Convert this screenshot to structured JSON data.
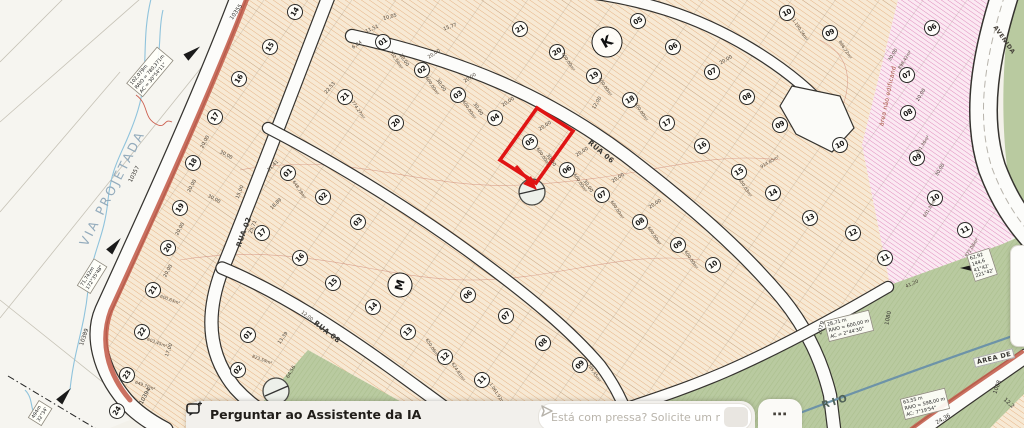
{
  "assistant_bar": {
    "ask_button": "Perguntar ao Assistente da IA",
    "input_placeholder": "Está com pressa? Solicite um resumo rápido",
    "more_label": "⋯"
  },
  "map": {
    "highlighted_lot": {
      "number": "05",
      "area": "600,00m²"
    },
    "colors": {
      "highlight": "#e01414",
      "road_stripe": "#c4604f",
      "lots_tan": "#f7e9d4",
      "lots_pink": "#fbe9f2",
      "green": "#b9caa0",
      "water": "#6d93a8"
    },
    "streets": [
      {
        "t": "VIA PROJETADA",
        "x": 112,
        "y": 188,
        "r": -63,
        "cls": "via"
      },
      {
        "t": "RUA 02",
        "x": 244,
        "y": 232,
        "r": -70,
        "cls": ""
      },
      {
        "t": "RUA 08",
        "x": 327,
        "y": 332,
        "r": 38,
        "cls": ""
      },
      {
        "t": "RUA 06",
        "x": 601,
        "y": 152,
        "r": 40,
        "cls": ""
      },
      {
        "t": "AVENIDA",
        "x": 1004,
        "y": 40,
        "r": 55,
        "cls": "ave"
      },
      {
        "t": "RIO",
        "x": 836,
        "y": 402,
        "r": -17,
        "cls": "rio"
      },
      {
        "t": "ÁREA DE",
        "x": 994,
        "y": 358,
        "r": -14,
        "cls": "areade"
      },
      {
        "t": "área não edificand",
        "x": 888,
        "y": 96,
        "r": -78,
        "cls": "nae"
      }
    ],
    "blocks": [
      {
        "t": "K",
        "x": 607,
        "y": 42,
        "r": -30,
        "cls": ""
      },
      {
        "t": "M",
        "x": 400,
        "y": 285,
        "r": -75,
        "cls": "m"
      }
    ],
    "lots": [
      {
        "n": "14",
        "x": 295,
        "y": 12,
        "r": -58
      },
      {
        "n": "15",
        "x": 270,
        "y": 47,
        "r": -58
      },
      {
        "n": "16",
        "x": 239,
        "y": 79,
        "r": -58
      },
      {
        "n": "17",
        "x": 215,
        "y": 117,
        "r": -58
      },
      {
        "n": "18",
        "x": 193,
        "y": 163,
        "r": -58
      },
      {
        "n": "19",
        "x": 180,
        "y": 208,
        "r": -58
      },
      {
        "n": "20",
        "x": 168,
        "y": 248,
        "r": -58
      },
      {
        "n": "21",
        "x": 153,
        "y": 290,
        "r": -58
      },
      {
        "n": "22",
        "x": 142,
        "y": 332,
        "r": -58
      },
      {
        "n": "23",
        "x": 127,
        "y": 375,
        "r": -58
      },
      {
        "n": "24",
        "x": 117,
        "y": 411,
        "r": -58
      },
      {
        "n": "01",
        "x": 288,
        "y": 173,
        "r": -45
      },
      {
        "n": "02",
        "x": 323,
        "y": 197,
        "r": -45
      },
      {
        "n": "03",
        "x": 358,
        "y": 222,
        "r": -45
      },
      {
        "n": "06",
        "x": 468,
        "y": 295,
        "r": -45
      },
      {
        "n": "07",
        "x": 506,
        "y": 316,
        "r": -45
      },
      {
        "n": "08",
        "x": 543,
        "y": 343,
        "r": -45
      },
      {
        "n": "09",
        "x": 580,
        "y": 365,
        "r": -45
      },
      {
        "n": "17",
        "x": 262,
        "y": 233,
        "r": -45
      },
      {
        "n": "16",
        "x": 300,
        "y": 258,
        "r": -45
      },
      {
        "n": "15",
        "x": 333,
        "y": 283,
        "r": -45
      },
      {
        "n": "14",
        "x": 373,
        "y": 307,
        "r": -45
      },
      {
        "n": "13",
        "x": 408,
        "y": 332,
        "r": -45
      },
      {
        "n": "12",
        "x": 445,
        "y": 357,
        "r": -45
      },
      {
        "n": "11",
        "x": 482,
        "y": 380,
        "r": -45
      },
      {
        "n": "21",
        "x": 345,
        "y": 97,
        "r": -45
      },
      {
        "n": "20",
        "x": 396,
        "y": 123,
        "r": -45
      },
      {
        "n": "01",
        "x": 383,
        "y": 42,
        "r": -35
      },
      {
        "n": "02",
        "x": 422,
        "y": 70,
        "r": -35
      },
      {
        "n": "03",
        "x": 458,
        "y": 95,
        "r": -35
      },
      {
        "n": "04",
        "x": 495,
        "y": 118,
        "r": -35
      },
      {
        "n": "05",
        "x": 530,
        "y": 142,
        "r": -35
      },
      {
        "n": "06",
        "x": 567,
        "y": 170,
        "r": -35
      },
      {
        "n": "07",
        "x": 602,
        "y": 195,
        "r": -35
      },
      {
        "n": "08",
        "x": 640,
        "y": 222,
        "r": -35
      },
      {
        "n": "09",
        "x": 678,
        "y": 245,
        "r": -35
      },
      {
        "n": "10",
        "x": 713,
        "y": 265,
        "r": -35
      },
      {
        "n": "21",
        "x": 520,
        "y": 29,
        "r": -33
      },
      {
        "n": "20",
        "x": 557,
        "y": 52,
        "r": -33
      },
      {
        "n": "19",
        "x": 594,
        "y": 76,
        "r": -33
      },
      {
        "n": "18",
        "x": 630,
        "y": 100,
        "r": -33
      },
      {
        "n": "17",
        "x": 667,
        "y": 123,
        "r": -33
      },
      {
        "n": "16",
        "x": 702,
        "y": 146,
        "r": -33
      },
      {
        "n": "15",
        "x": 739,
        "y": 172,
        "r": -33
      },
      {
        "n": "05",
        "x": 638,
        "y": 21,
        "r": -30
      },
      {
        "n": "06",
        "x": 673,
        "y": 47,
        "r": -30
      },
      {
        "n": "07",
        "x": 712,
        "y": 72,
        "r": -30
      },
      {
        "n": "08",
        "x": 747,
        "y": 97,
        "r": -30
      },
      {
        "n": "09",
        "x": 780,
        "y": 125,
        "r": -30
      },
      {
        "n": "10",
        "x": 787,
        "y": 13,
        "r": -28
      },
      {
        "n": "09",
        "x": 830,
        "y": 33,
        "r": -28
      },
      {
        "n": "10",
        "x": 840,
        "y": 145,
        "r": -28
      },
      {
        "n": "14",
        "x": 773,
        "y": 193,
        "r": -28
      },
      {
        "n": "13",
        "x": 810,
        "y": 218,
        "r": -28
      },
      {
        "n": "12",
        "x": 853,
        "y": 233,
        "r": -28
      },
      {
        "n": "11",
        "x": 885,
        "y": 258,
        "r": -28
      },
      {
        "n": "01",
        "x": 248,
        "y": 335,
        "r": -50
      },
      {
        "n": "02",
        "x": 238,
        "y": 370,
        "r": -50
      },
      {
        "n": "06",
        "x": 932,
        "y": 28,
        "r": -30,
        "p": 1
      },
      {
        "n": "07",
        "x": 907,
        "y": 75,
        "r": -30,
        "p": 1
      },
      {
        "n": "08",
        "x": 908,
        "y": 113,
        "r": -30,
        "p": 1
      },
      {
        "n": "09",
        "x": 917,
        "y": 158,
        "r": -30,
        "p": 1
      },
      {
        "n": "10",
        "x": 935,
        "y": 198,
        "r": -30,
        "p": 1
      },
      {
        "n": "11",
        "x": 965,
        "y": 230,
        "r": -30,
        "p": 1
      }
    ],
    "dims": [
      {
        "t": "20,00",
        "x": 434,
        "y": 54,
        "r": -33
      },
      {
        "t": "20,00",
        "x": 470,
        "y": 78,
        "r": -33
      },
      {
        "t": "20,00",
        "x": 508,
        "y": 102,
        "r": -33
      },
      {
        "t": "20,00",
        "x": 545,
        "y": 126,
        "r": -33
      },
      {
        "t": "20,00",
        "x": 582,
        "y": 152,
        "r": -33
      },
      {
        "t": "20,00",
        "x": 618,
        "y": 178,
        "r": -33
      },
      {
        "t": "20,00",
        "x": 655,
        "y": 204,
        "r": -33
      },
      {
        "t": "20,00",
        "x": 205,
        "y": 142,
        "r": -62
      },
      {
        "t": "20,00",
        "x": 192,
        "y": 186,
        "r": -62
      },
      {
        "t": "20,00",
        "x": 180,
        "y": 229,
        "r": -62
      },
      {
        "t": "20,00",
        "x": 168,
        "y": 271,
        "r": -62
      },
      {
        "t": "20,00",
        "x": 921,
        "y": 95,
        "r": -58
      },
      {
        "t": "20,00",
        "x": 726,
        "y": 60,
        "r": -30
      },
      {
        "t": "30,00",
        "x": 404,
        "y": 60,
        "r": 57
      },
      {
        "t": "30,00",
        "x": 441,
        "y": 85,
        "r": 57
      },
      {
        "t": "30,00",
        "x": 478,
        "y": 109,
        "r": 57
      },
      {
        "t": "30,00",
        "x": 551,
        "y": 160,
        "r": 57
      },
      {
        "t": "30,00",
        "x": 588,
        "y": 186,
        "r": 57
      },
      {
        "t": "30,00",
        "x": 226,
        "y": 155,
        "r": 28
      },
      {
        "t": "30,00",
        "x": 214,
        "y": 199,
        "r": 28
      },
      {
        "t": "30,00",
        "x": 893,
        "y": 55,
        "r": -58
      },
      {
        "t": "30,00",
        "x": 940,
        "y": 170,
        "r": -58
      },
      {
        "t": "12,00",
        "x": 597,
        "y": 103,
        "r": -60
      },
      {
        "t": "12,00",
        "x": 307,
        "y": 316,
        "r": 38
      },
      {
        "t": "15,00",
        "x": 240,
        "y": 192,
        "r": -68
      },
      {
        "t": "10,05",
        "x": 390,
        "y": 17,
        "r": -15
      },
      {
        "t": "15,77",
        "x": 450,
        "y": 27,
        "r": -20
      },
      {
        "t": "11,51",
        "x": 372,
        "y": 29,
        "r": -25
      },
      {
        "t": "6,84",
        "x": 357,
        "y": 45,
        "r": -35
      },
      {
        "t": "22,53",
        "x": 330,
        "y": 88,
        "r": -50
      },
      {
        "t": "31,41",
        "x": 273,
        "y": 166,
        "r": -45
      },
      {
        "t": "25,71",
        "x": 253,
        "y": 227,
        "r": -68
      },
      {
        "t": "18,89",
        "x": 276,
        "y": 204,
        "r": -45
      },
      {
        "t": "13,39",
        "x": 283,
        "y": 338,
        "r": -55
      },
      {
        "t": "64,56",
        "x": 291,
        "y": 372,
        "r": -60
      },
      {
        "t": "17,00",
        "x": 169,
        "y": 350,
        "r": -70
      },
      {
        "t": "41,20",
        "x": 912,
        "y": 284,
        "r": -25
      }
    ],
    "areas": [
      {
        "t": "600,00m²",
        "x": 543,
        "y": 157,
        "r": 57
      },
      {
        "t": "600,00m²",
        "x": 580,
        "y": 183,
        "r": 57
      },
      {
        "t": "600,00m²",
        "x": 617,
        "y": 210,
        "r": 57
      },
      {
        "t": "600,00m²",
        "x": 469,
        "y": 110,
        "r": 57
      },
      {
        "t": "600,00m²",
        "x": 432,
        "y": 86,
        "r": 57
      },
      {
        "t": "600,00m²",
        "x": 654,
        "y": 236,
        "r": 57
      },
      {
        "t": "600,00m²",
        "x": 691,
        "y": 260,
        "r": 57
      },
      {
        "t": "600,00m²",
        "x": 568,
        "y": 62,
        "r": 57
      },
      {
        "t": "600,00m²",
        "x": 605,
        "y": 87,
        "r": 57
      },
      {
        "t": "600,00m²",
        "x": 641,
        "y": 112,
        "r": 57
      },
      {
        "t": "702,54m²",
        "x": 396,
        "y": 60,
        "r": 57
      },
      {
        "t": "774,27m²",
        "x": 358,
        "y": 110,
        "r": 57
      },
      {
        "t": "648,78m²",
        "x": 299,
        "y": 190,
        "r": 57
      },
      {
        "t": "650,03m²",
        "x": 745,
        "y": 188,
        "r": 57
      },
      {
        "t": "624,81m²",
        "x": 458,
        "y": 372,
        "r": 57
      },
      {
        "t": "785,45m²",
        "x": 594,
        "y": 373,
        "r": 57
      },
      {
        "t": "650,06m²",
        "x": 432,
        "y": 348,
        "r": 57
      },
      {
        "t": "896,72m²",
        "x": 845,
        "y": 50,
        "r": 57
      },
      {
        "t": "1.190,26m²",
        "x": 800,
        "y": 30,
        "r": 57
      },
      {
        "t": "1.061,92m²",
        "x": 497,
        "y": 394,
        "r": 57
      },
      {
        "t": "914,85m²",
        "x": 770,
        "y": 162,
        "r": -30
      },
      {
        "t": "600,63m²",
        "x": 170,
        "y": 300,
        "r": 20
      },
      {
        "t": "603,45m²",
        "x": 157,
        "y": 343,
        "r": 20
      },
      {
        "t": "649,70m²",
        "x": 145,
        "y": 386,
        "r": 20
      },
      {
        "t": "823,59m²",
        "x": 262,
        "y": 360,
        "r": 20
      },
      {
        "t": "898,42m²",
        "x": 905,
        "y": 60,
        "r": -58
      },
      {
        "t": "601,36m²",
        "x": 923,
        "y": 145,
        "r": -58
      },
      {
        "t": "601,30m²",
        "x": 930,
        "y": 208,
        "r": -58
      },
      {
        "t": "872,08m²",
        "x": 972,
        "y": 248,
        "r": -58
      }
    ],
    "ids": [
      {
        "t": "10355",
        "x": 236,
        "y": 12,
        "r": -55
      },
      {
        "t": "10357",
        "x": 134,
        "y": 174,
        "r": -63
      },
      {
        "t": "10389",
        "x": 84,
        "y": 337,
        "r": -72
      },
      {
        "t": "10394",
        "x": 145,
        "y": 396,
        "r": -62
      },
      {
        "t": "1079",
        "x": 821,
        "y": 328,
        "r": -75
      },
      {
        "t": "1080",
        "x": 888,
        "y": 318,
        "r": -78
      },
      {
        "t": "1088",
        "x": 997,
        "y": 387,
        "r": -70
      },
      {
        "t": "24,36",
        "x": 943,
        "y": 419,
        "r": -30
      },
      {
        "t": "12,2",
        "x": 1009,
        "y": 403,
        "r": 42
      }
    ],
    "measures": [
      {
        "x": 150,
        "y": 72,
        "r": -50,
        "lines": [
          "102,079m",
          "RAIO = 780,371m",
          "AC = 30°54'11\""
        ]
      },
      {
        "x": 92,
        "y": 276,
        "r": -58,
        "lines": [
          "71,742m",
          "172°35'48\""
        ]
      },
      {
        "x": 40,
        "y": 413,
        "r": -58,
        "lines": [
          "494m",
          "32°34'"
        ]
      },
      {
        "x": 849,
        "y": 326,
        "r": -14,
        "lines": [
          "28,71 m",
          "RAIO = 600,00 m",
          "AC = 2°44'30\""
        ]
      },
      {
        "x": 925,
        "y": 404,
        "r": -14,
        "lines": [
          "63,55 m",
          "RAIO = 598,00 m",
          "AC: 7°19'54\""
        ]
      },
      {
        "x": 982,
        "y": 265,
        "r": -18,
        "lines": [
          "62,92",
          "144,6",
          "41°42'",
          "221°42'"
        ]
      }
    ]
  }
}
